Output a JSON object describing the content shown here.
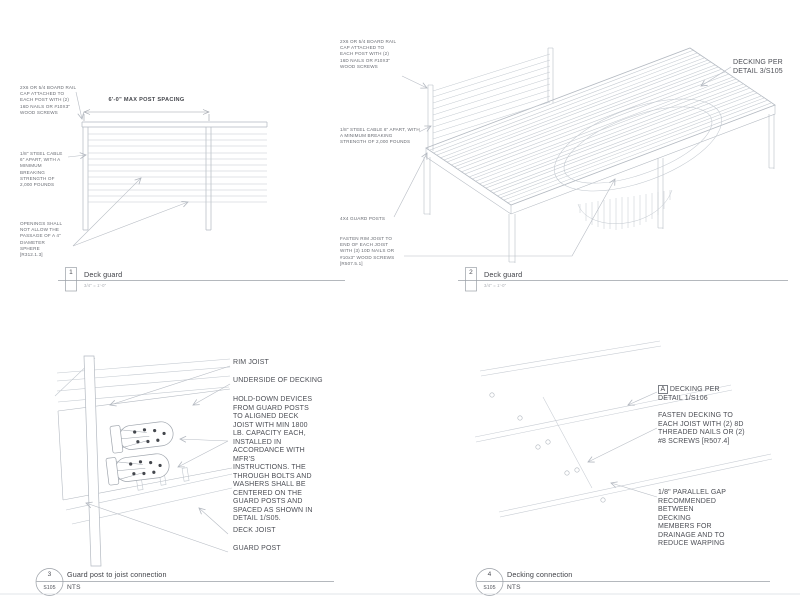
{
  "colors": {
    "line_light": "#c7ccd3",
    "line_dark": "#b3b9c1",
    "leader": "#b7bcc4",
    "text": "#4c4e55",
    "bolt_dot": "#43464c"
  },
  "details": {
    "d1": {
      "number": "1",
      "title": "Deck guard",
      "scale": "3/4\" = 1'-0\"",
      "dim_label": "6'-0\" MAX POST SPACING",
      "notes": {
        "rail_cap": "2X6 OR 5/4 BOARD RAIL CAP ATTACHED TO EACH POST WITH (2) 16D NAILS OR #10X3\" WOOD SCREWS",
        "cable": "1/8\" STEEL CABLE 6\" APART, WITH A MINIMUM BREAKING STRENGTH OF 2,000 POUNDS",
        "openings": "OPENINGS SHALL NOT ALLOW THE PASSAGE OF A 4\" DIAMETER SPHERE [R312.1.3]"
      }
    },
    "d2": {
      "number": "2",
      "title": "Deck guard",
      "scale": "3/4\" = 1'-0\"",
      "notes": {
        "rail_cap": "2X6 OR 5/4 BOARD RAIL CAP ATTACHED TO EACH POST WITH (2) 16D NAILS OR #10X3\" WOOD SCREWS",
        "cable": "1/8\" STEEL CABLE 6\" APART, WITH A MINIMUM BREAKING STRENGTH OF 2,000 POUNDS",
        "guard_posts": "4X4 GUARD POSTS",
        "rim_joist": "FASTEN RIM JOIST TO END OF EACH JOIST WITH (3) 10D NAILS OR #10x3\" WOOD SCREWS [R507.5.1]",
        "decking": "DECKING PER DETAIL 3/S105"
      }
    },
    "d3": {
      "number": "3",
      "sheet": "S105",
      "title": "Guard post to joist connection",
      "scale": "NTS",
      "notes": {
        "rim_joist": "RIM JOIST",
        "underside": "UNDERSIDE OF DECKING",
        "hold_down": "HOLD-DOWN DEVICES FROM GUARD POSTS TO ALIGNED DECK JOIST WITH MIN 1800 LB. CAPACITY EACH, INSTALLED IN ACCORDANCE WITH MFR'S INSTRUCTIONS. THE THROUGH BOLTS AND WASHERS SHALL BE CENTERED ON THE GUARD POSTS AND SPACED AS SHOWN IN DETAIL 1/S05.",
        "deck_joist": "DECK JOIST",
        "guard_post": "GUARD POST"
      }
    },
    "d4": {
      "number": "4",
      "sheet": "S105",
      "title": "Decking connection",
      "scale": "NTS",
      "notes": {
        "decking_marker": "A",
        "decking": "DECKING PER DETAIL 1/S106",
        "fasten": "FASTEN DECKING TO EACH JOIST WITH (2) 8D THREADED NAILS OR (2) #8 SCREWS [R507.4]",
        "gap": "1/8\" PARALLEL GAP RECOMMENDED BETWEEN DECKING MEMBERS FOR DRAINAGE AND TO REDUCE WARPING"
      }
    }
  }
}
